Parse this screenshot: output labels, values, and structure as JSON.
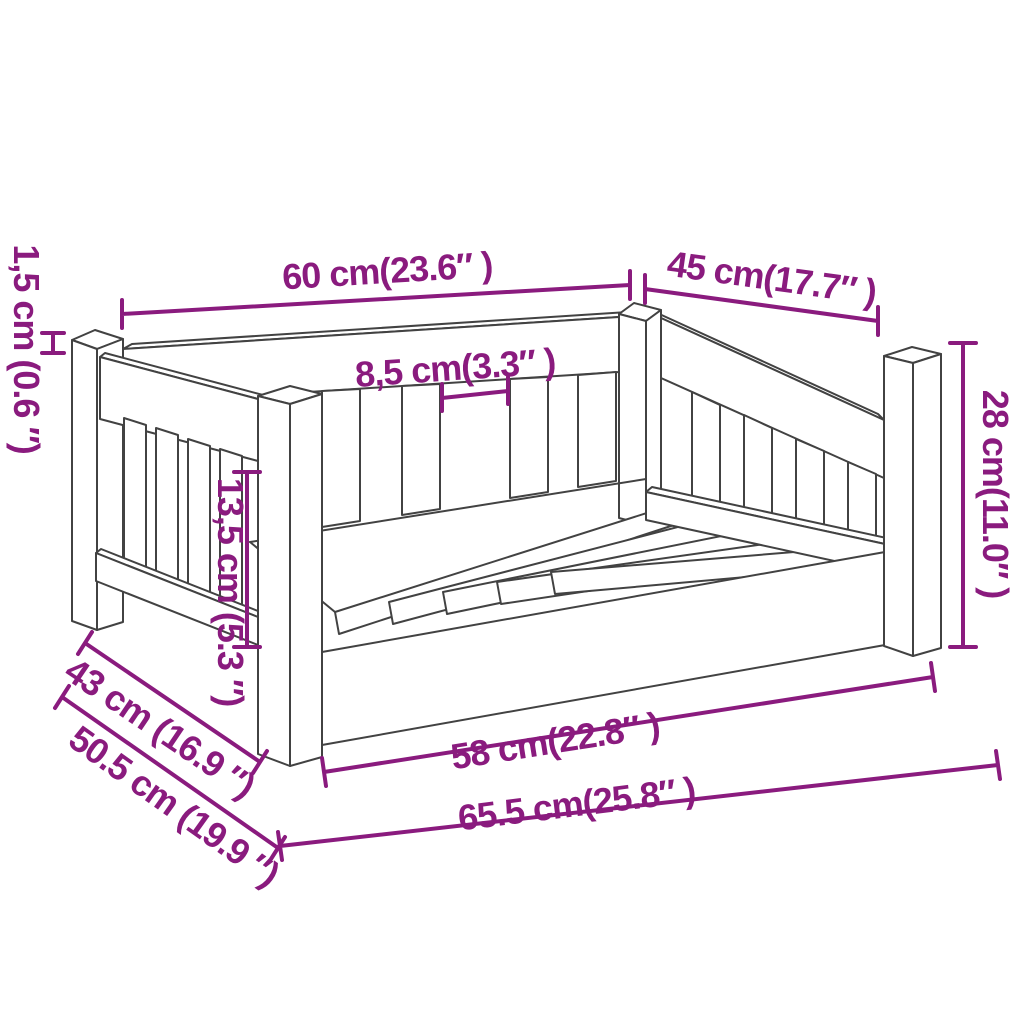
{
  "diagram": {
    "subject": "dog-bed-technical-drawing",
    "colors": {
      "annotation": "#8a1b7e",
      "line": "#424242",
      "background": "#ffffff"
    },
    "dims": {
      "d60": "60 cm(23.6″ )",
      "d45": "45 cm(17.7″ )",
      "d85": "8,5 cm(3.3″ )",
      "d15": "1,5 cm (0.6 ″)",
      "d135": "13,5 cm (5.3 ″)",
      "d28": "28 cm(11.0″ )",
      "d58": "58 cm(22.8″ )",
      "d655": "65.5 cm(25.8″ )",
      "d43": "43 cm (16.9 ″)",
      "d50": "50.5 cm (19.9 ″)"
    }
  }
}
